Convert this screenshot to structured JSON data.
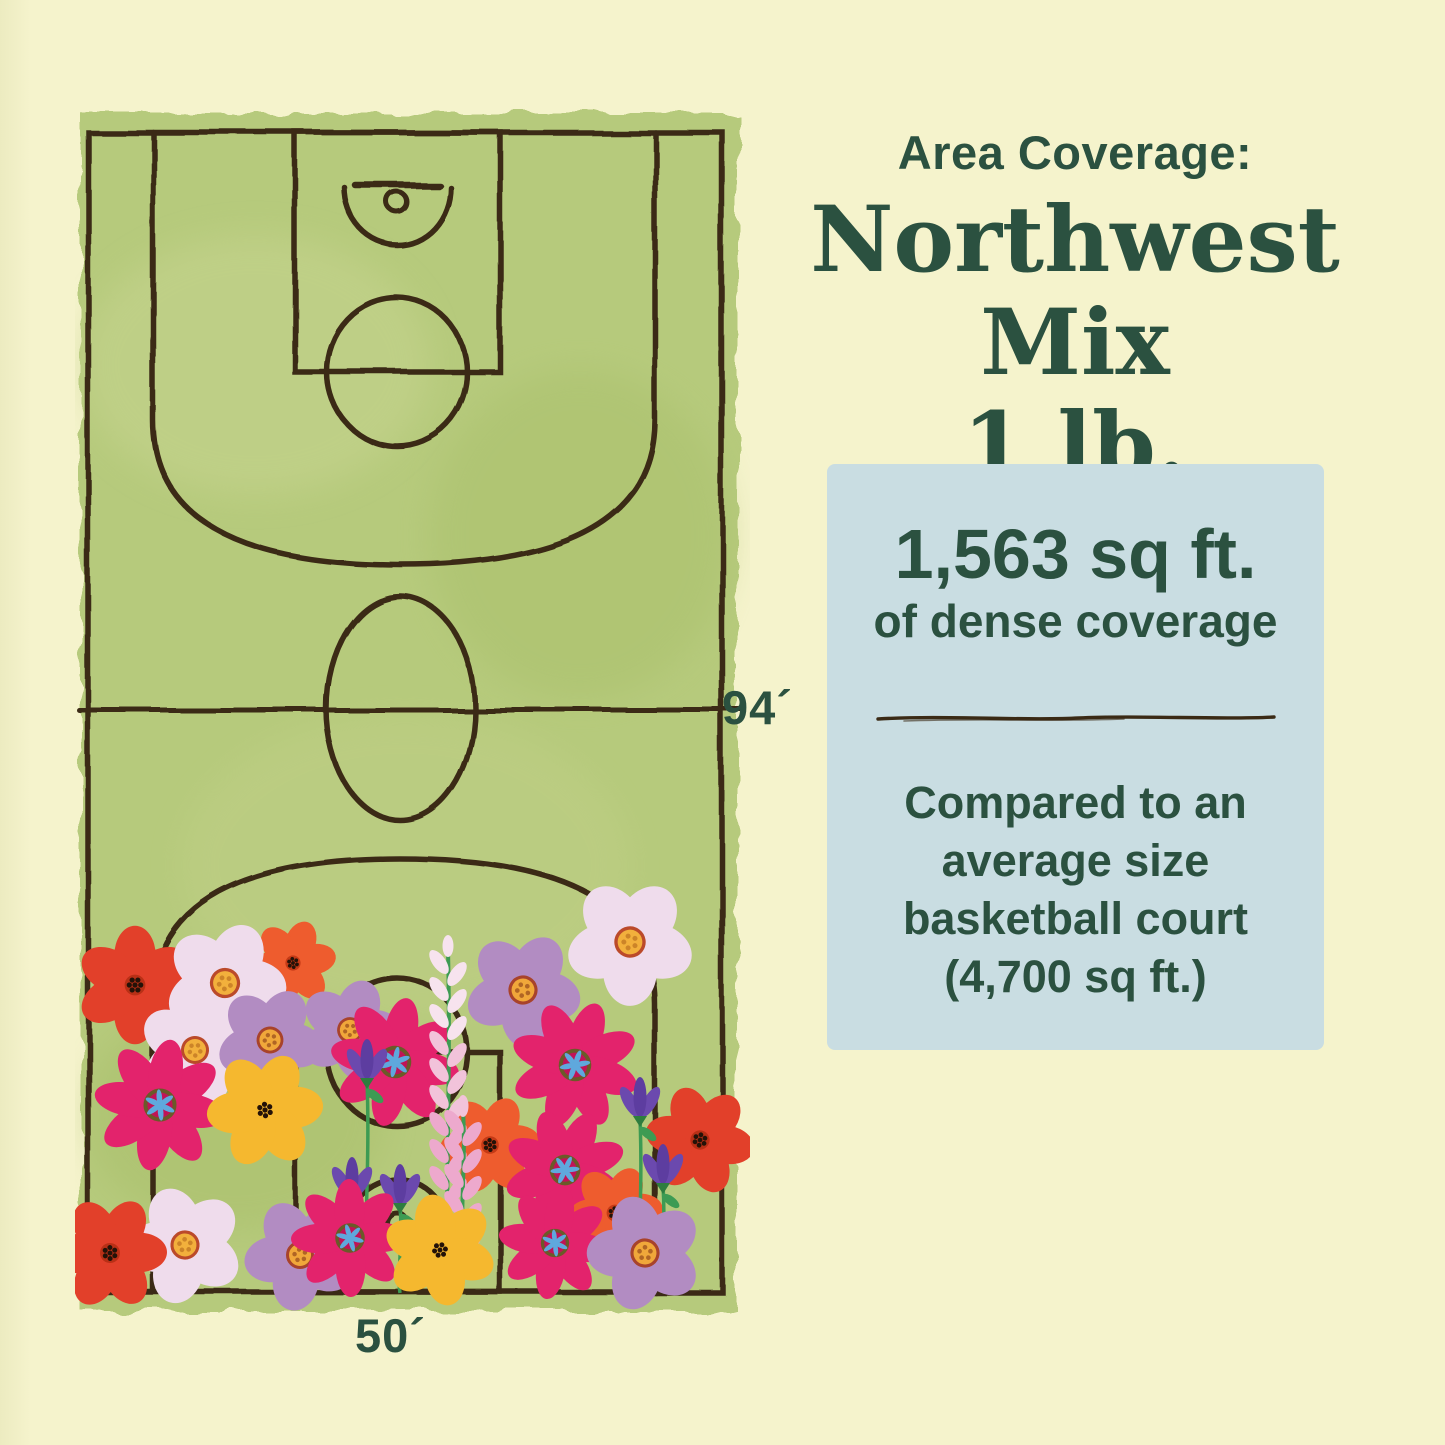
{
  "page": {
    "background_color": "#f5f3cc",
    "text_color": "#2b5140"
  },
  "header": {
    "eyebrow": "Area Coverage:",
    "title": "Northwest Mix",
    "weight": "1 lb."
  },
  "coverage_card": {
    "background_color": "#c9dde2",
    "headline": "1,563 sq ft.",
    "subheadline": "of dense coverage",
    "comparison_lines": [
      "Compared to an",
      "average size",
      "basketball court",
      "(4,700 sq ft.)"
    ]
  },
  "court": {
    "length_label": "94´",
    "width_label": "50´",
    "floor_color": "#b6ca7c",
    "line_color": "#3b2a15"
  },
  "illustration": {
    "description": "hand-drawn basketball court with wildflowers covering the lower end",
    "palette": {
      "court_green": "#b6ca7c",
      "court_green_light": "#c6d48f",
      "court_green_dark": "#a3ba64",
      "line_brown": "#3b2a15",
      "red": "#e2402a",
      "red_orange": "#ee5c2e",
      "magenta": "#e3236c",
      "magenta_deep": "#c01356",
      "lavender": "#b28cc2",
      "pale_pink": "#efdcec",
      "yellow": "#f5b82f",
      "purple": "#6b49ae",
      "purple_deep": "#5d3da0",
      "blue_center": "#5fa8dd",
      "stem": "#3d9b53",
      "leaf": "#2e7d3f",
      "spike_pink_light": "#f7e3ee",
      "spike_pink": "#f2c3da",
      "spike_pink_deep": "#eda9cd",
      "center_orange": "#f0a73a",
      "center_ring_red": "#a8432b",
      "dot_dark": "#241208"
    }
  }
}
